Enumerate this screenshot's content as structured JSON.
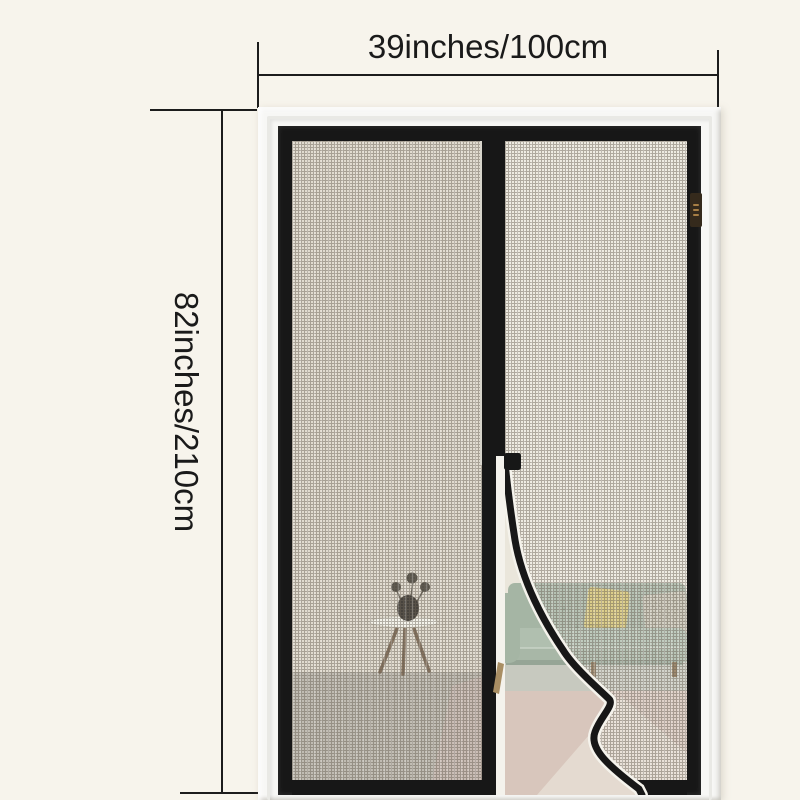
{
  "annotations": {
    "width_label": "39inches/100cm",
    "height_label": "82inches/210cm",
    "line_color": "#1c1c1c"
  },
  "colors": {
    "background": "#f7f4ec",
    "frame_white": "#f7f7f5",
    "frame_black": "#171717",
    "mesh_wall": "#dcd6c9",
    "mesh_floor": "#b6b1a7",
    "mesh_floor_pink": "#c3b2a9",
    "open_wall": "#eae6db",
    "open_floor": "#d8c6bc",
    "floor_wedge": "#e5dbd2",
    "under_sofa_band": "#c7c9bf",
    "sofa": "#a5b5a4",
    "sofa_seat": "#b0bfaf",
    "sofa_front": "#a8b7a7",
    "pillow_yellow": "#d5c470",
    "pillow_gray": "#c8c5b6",
    "table_top": "#f4f2ea",
    "table_leg": "#6e5741",
    "vase": "#26211b",
    "tag": "#352a1c",
    "panel_edge_white": "#f4f2ec",
    "curve_highlight": "#f5f3ec"
  }
}
